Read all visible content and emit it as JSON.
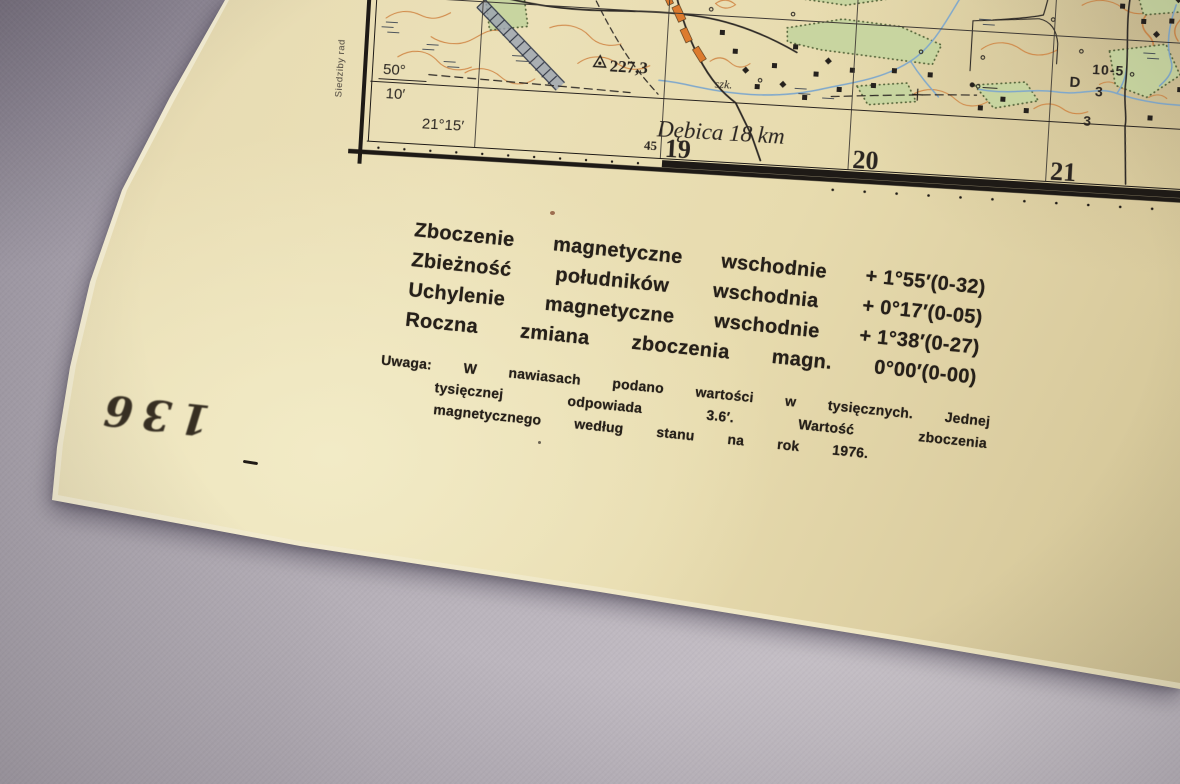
{
  "map": {
    "margin": {
      "latitude_deg": "50°",
      "latitude_min": "10′",
      "longitude": "21°15′",
      "road_destination": "Dębica 18 km",
      "grid_prefix": "45",
      "grid_numbers": [
        "19",
        "20",
        "21"
      ],
      "edge_note_vertical": "Siedziby rad"
    },
    "features": {
      "spot_height": "227,3",
      "school_abbr": "szk.",
      "district_letter": "D",
      "plot_numbers": [
        "10-5",
        "3",
        "3"
      ]
    },
    "colors": {
      "contour": "#cf8240",
      "forest": "#c8d5a0",
      "water": "#7fa8cc",
      "village": "#dc7b2e",
      "ink": "#2a2521",
      "paper": "#e9ddb0"
    }
  },
  "declination_block": {
    "lines": [
      {
        "words": [
          "Zboczenie",
          "magnetyczne",
          "wschodnie"
        ],
        "value": "+ 1°55′(0-32)"
      },
      {
        "words": [
          "Zbieżność",
          "południków",
          "wschodnia"
        ],
        "value": "+ 0°17′(0-05)"
      },
      {
        "words": [
          "Uchylenie",
          "magnetyczne",
          "wschodnie"
        ],
        "value": "+ 1°38′(0-27)"
      },
      {
        "words": [
          "Roczna",
          "zmiana",
          "zboczenia",
          "magn."
        ],
        "value": "0°00′(0-00)"
      }
    ],
    "note_lines": [
      [
        "Uwaga:",
        "W",
        "nawiasach",
        "podano",
        "wartości",
        "w",
        "tysięcznych.",
        "Jednej"
      ],
      [
        "tysięcznej",
        "odpowiada",
        "3.6′.",
        "Wartość",
        "zboczenia"
      ],
      [
        "magnetycznego",
        "według",
        "stanu",
        "na",
        "rok",
        "1976."
      ]
    ]
  },
  "stamp": {
    "number": "136"
  }
}
